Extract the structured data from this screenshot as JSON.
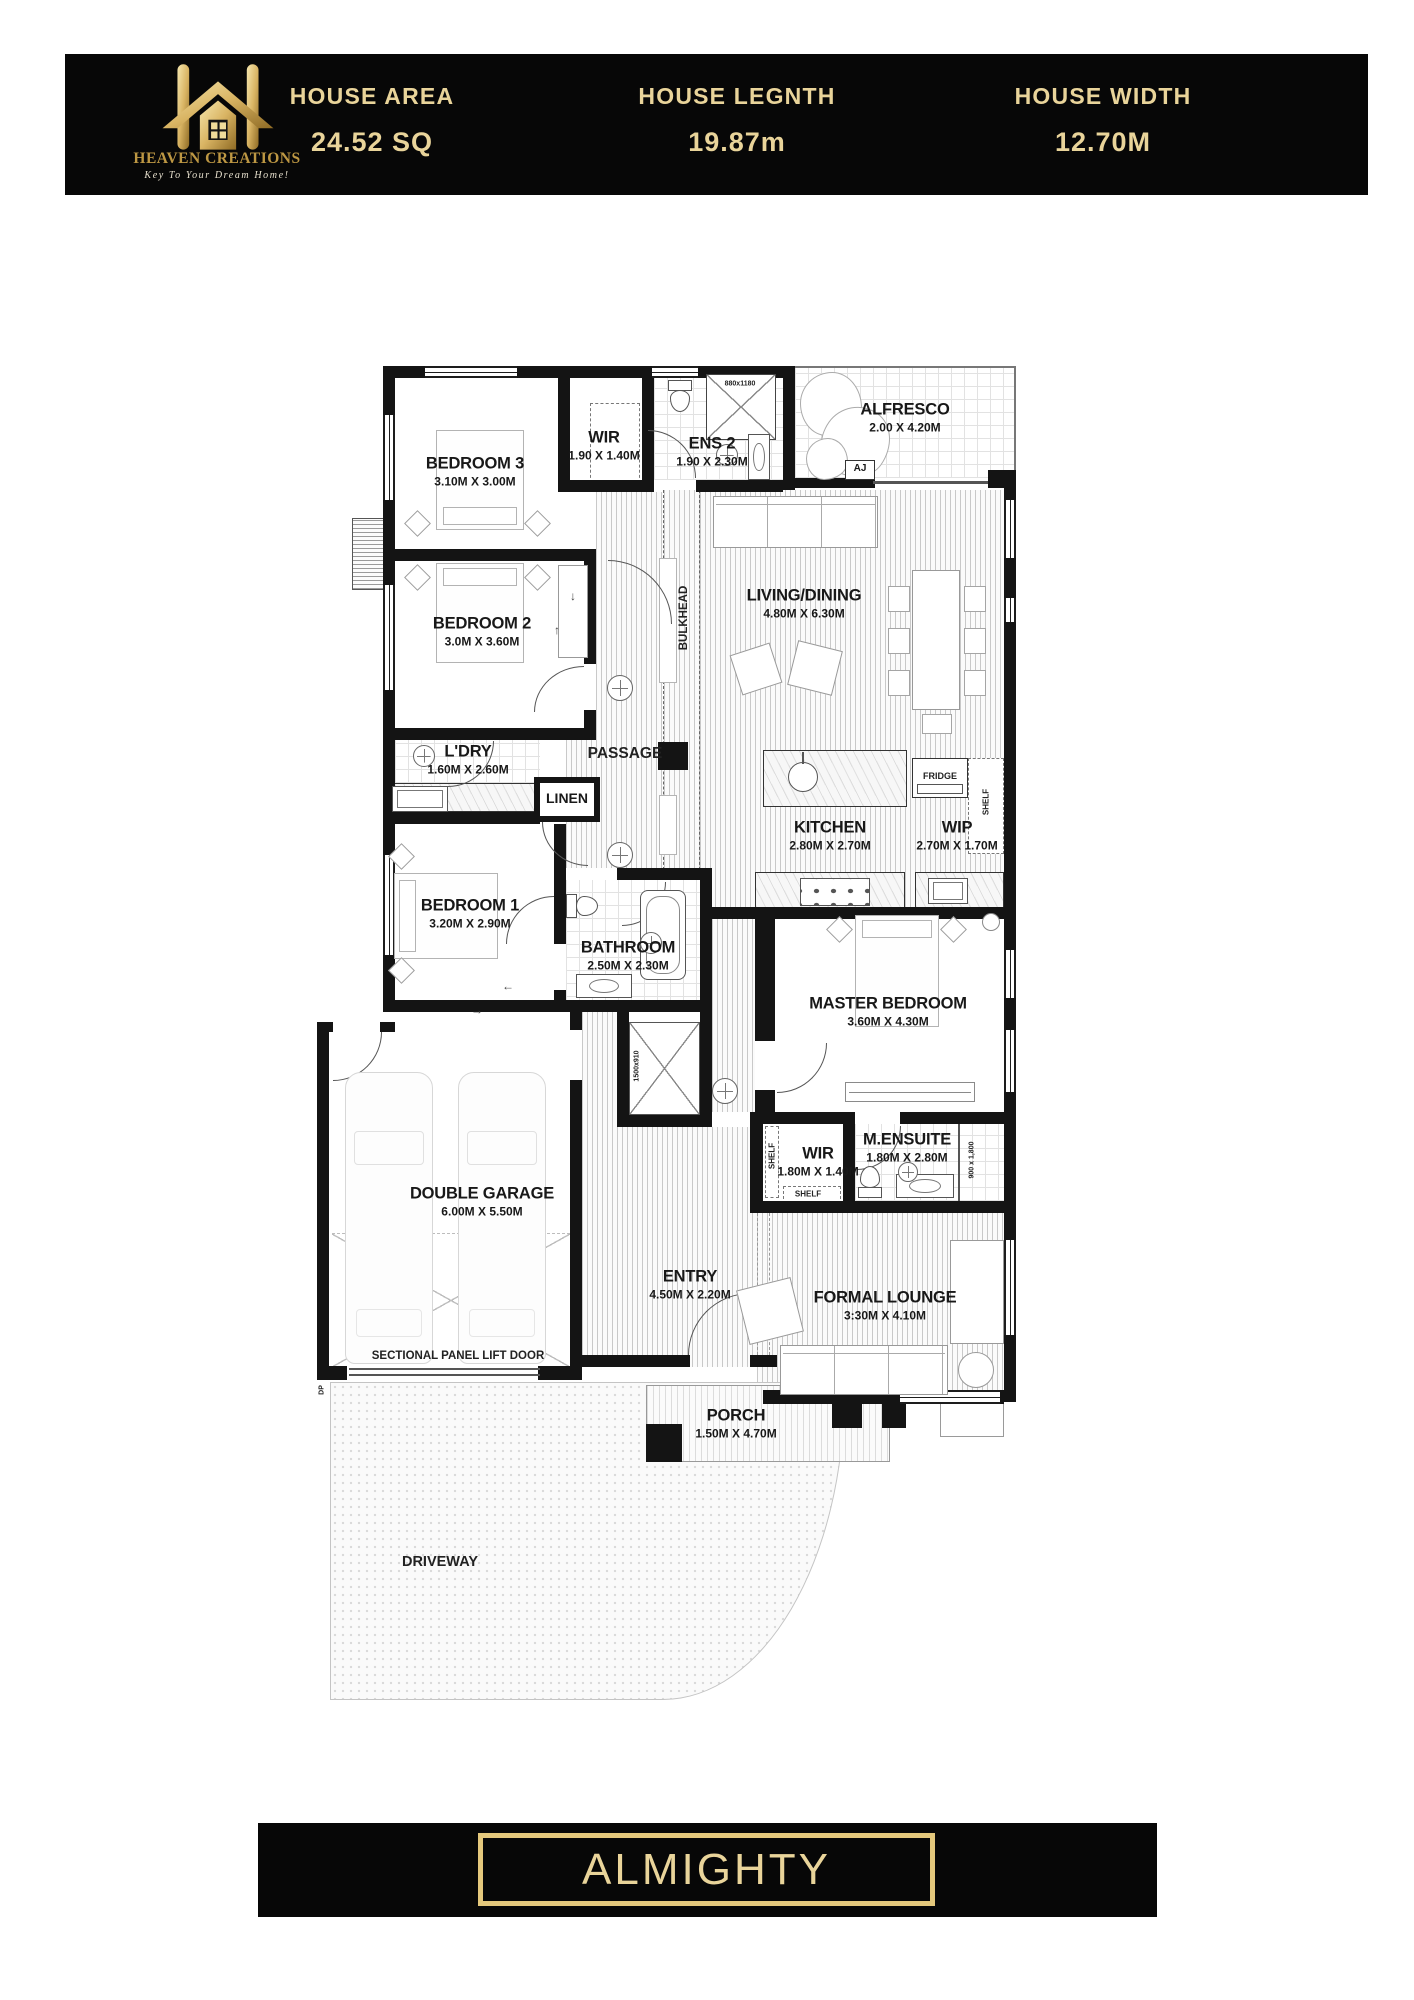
{
  "header": {
    "brand": {
      "name": "HEAVEN CREATIONS",
      "tagline": "Key To Your Dream Home!"
    },
    "stats": [
      {
        "label": "HOUSE AREA",
        "value": "24.52 SQ"
      },
      {
        "label": "HOUSE LEGNTH",
        "value": "19.87m"
      },
      {
        "label": "HOUSE WIDTH",
        "value": "12.70M"
      }
    ]
  },
  "plan": {
    "rooms": {
      "bedroom3": {
        "name": "BEDROOM 3",
        "dims": "3.10M X 3.00M"
      },
      "wir_top": {
        "name": "WIR",
        "dims": "1.90 X 1.40M"
      },
      "ens2": {
        "name": "ENS 2",
        "dims": "1.90 X 2.30M"
      },
      "alfresco": {
        "name": "ALFRESCO",
        "dims": "2.00 X 4.20M"
      },
      "living": {
        "name": "LIVING/DINING",
        "dims": "4.80M X 6.30M"
      },
      "bedroom2": {
        "name": "BEDROOM 2",
        "dims": "3.0M X 3.60M"
      },
      "ldry": {
        "name": "L'DRY",
        "dims": "1.60M X 2.60M"
      },
      "passage": {
        "name": "PASSAGE"
      },
      "linen": {
        "name": "LINEN"
      },
      "kitchen": {
        "name": "KITCHEN",
        "dims": "2.80M X 2.70M"
      },
      "wip": {
        "name": "WIP",
        "dims": "2.70M X 1.70M"
      },
      "bedroom1": {
        "name": "BEDROOM 1",
        "dims": "3.20M X 2.90M"
      },
      "bathroom": {
        "name": "BATHROOM",
        "dims": "2.50M X 2.30M"
      },
      "master": {
        "name": "MASTER BEDROOM",
        "dims": "3.60M X 4.30M"
      },
      "garage": {
        "name": "DOUBLE GARAGE",
        "dims": "6.00M X 5.50M"
      },
      "wir_master": {
        "name": "WIR",
        "dims": "1.80M X 1.40M"
      },
      "mensuite": {
        "name": "M.ENSUITE",
        "dims": "1.80M X 2.80M"
      },
      "entry": {
        "name": "ENTRY",
        "dims": "4.50M X 2.20M"
      },
      "lounge": {
        "name": "FORMAL LOUNGE",
        "dims": "3:30M X 4.10M"
      },
      "porch": {
        "name": "PORCH",
        "dims": "1.50M X 4.70M"
      },
      "driveway": {
        "name": "DRIVEWAY"
      }
    },
    "annotations": {
      "bulkhead": "BULKHEAD",
      "shelf": "SHELF",
      "fridge": "FRIDGE",
      "sectional_door": "SECTIONAL PANEL LIFT DOOR",
      "dp": "DP",
      "aj": "AJ",
      "shower_ens2": "880x1180",
      "shower_bath": "1500x910",
      "shower_ensuite": "900 x 1,800",
      "arrow_up": "↑",
      "arrow_down": "↓",
      "arrow_left": "←",
      "arrow_right": "→"
    }
  },
  "footer": {
    "plan_name": "ALMIGHTY"
  }
}
